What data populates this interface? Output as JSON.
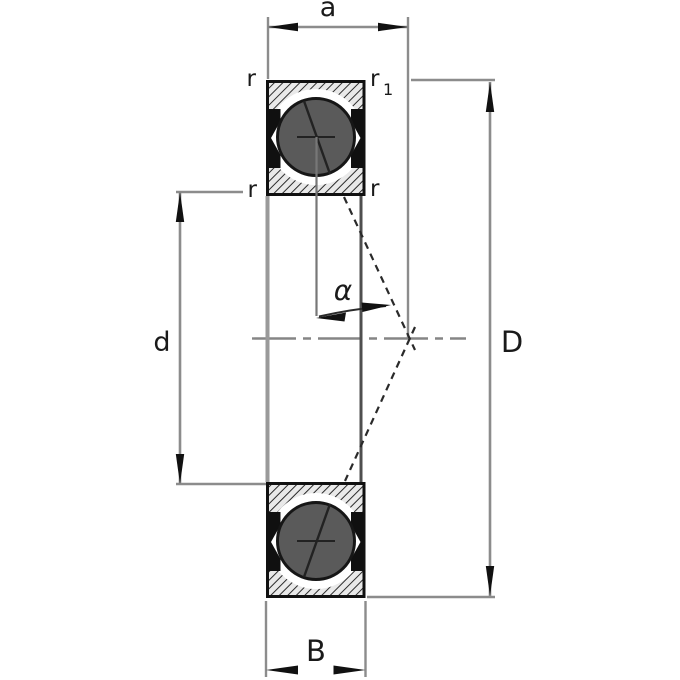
{
  "diagram": {
    "type": "spindle-bearing-cross-section",
    "labels": {
      "dim_a": "a",
      "chamfer_top_left": "r",
      "chamfer_top_right_base": "r",
      "chamfer_top_right_sub": "1",
      "chamfer_mid_left": "r",
      "chamfer_mid_right": "r",
      "contact_angle": "α",
      "dim_bore": "d",
      "dim_outer": "D",
      "dim_width": "B"
    },
    "colors": {
      "background": "#ffffff",
      "dimension_line": "#8c8c8c",
      "text": "#1a1a1a",
      "arrow": "#111111",
      "ball_fill": "#5a5a5a",
      "ball_stroke": "#161616",
      "seal": "#101010",
      "hatch_line": "#222222",
      "hatch_bg": "#e9e9e9",
      "ring_outline": "#111111",
      "bore_silhouette": "#9a9a9a",
      "od_silhouette": "#4f4f4f",
      "centerline": "#858585",
      "contact_line": "#2a2a2a"
    }
  }
}
